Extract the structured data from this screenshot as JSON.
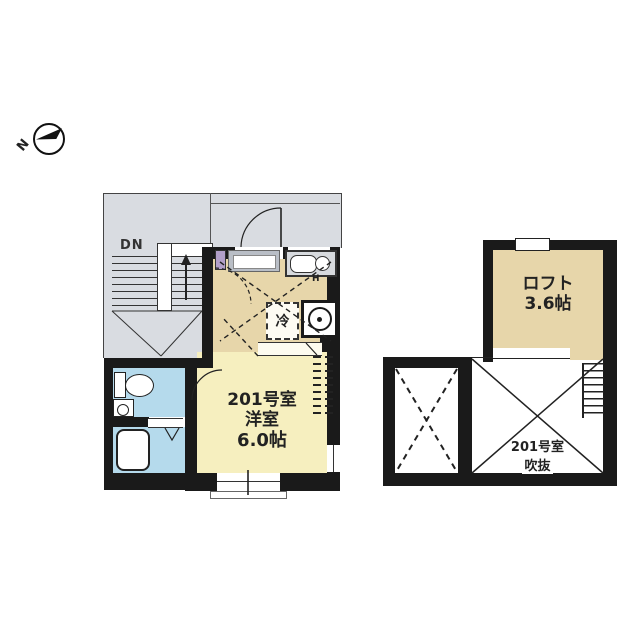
{
  "compass": {
    "north_label": "N"
  },
  "main_plan": {
    "stairs_down_label": "DN",
    "room_number": "201号室",
    "room_type": "洋室",
    "room_size": "6.0帖",
    "refrigerator_label": "冷",
    "burner_label": "H"
  },
  "loft_plan": {
    "loft_name": "ロフト",
    "loft_size": "3.6帖",
    "void_room_number": "201号室",
    "void_label": "吹抜"
  },
  "colors": {
    "common_area": "#d9dce1",
    "kitchen_floor": "#e7d6aa",
    "room_floor": "#f6efbf",
    "bathroom_floor": "#b5daec",
    "loft_floor": "#e7d6aa",
    "wall": "#1a1a1a",
    "shoe_cabinet": "#b29fc9"
  }
}
